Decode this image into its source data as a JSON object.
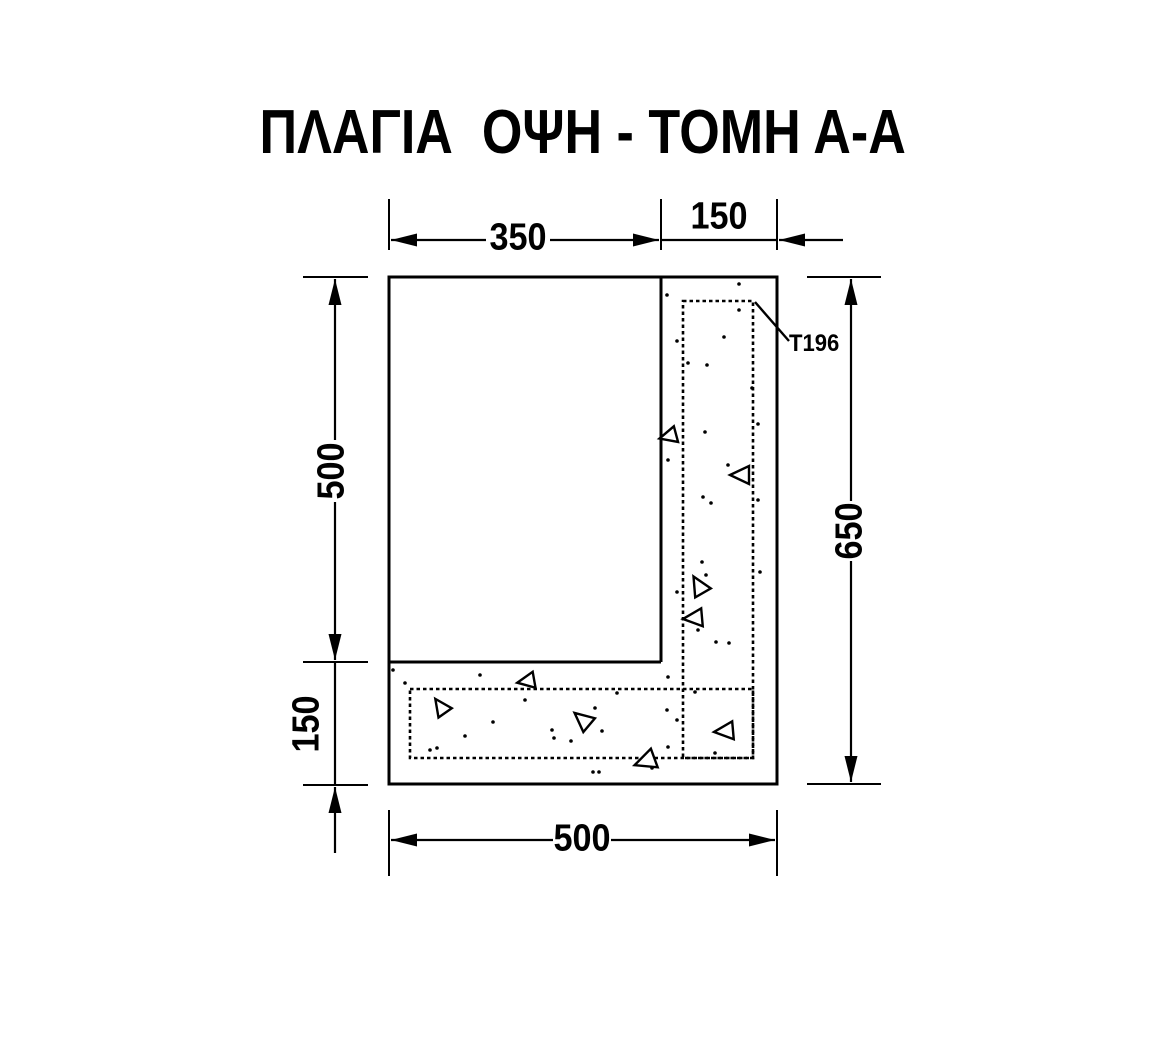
{
  "title": "ΠΛΑΓΙΑ  ΟΨΗ - ΤΟΜΗ Α-Α",
  "labels": {
    "dim_top_main": "350",
    "dim_top_wall": "150",
    "dim_left_upper": "500",
    "dim_left_lower": "150",
    "dim_right_total": "650",
    "dim_bottom_total": "500",
    "mesh_label": "T196"
  },
  "colors": {
    "ink": "#000000",
    "paper": "#ffffff"
  },
  "texture": {
    "dots": [
      [
        739,
        284
      ],
      [
        667,
        295
      ],
      [
        739,
        310
      ],
      [
        677,
        341
      ],
      [
        724,
        337
      ],
      [
        688,
        363
      ],
      [
        707,
        365
      ],
      [
        752,
        388
      ],
      [
        758,
        424
      ],
      [
        705,
        432
      ],
      [
        668,
        460
      ],
      [
        728,
        465
      ],
      [
        758,
        500
      ],
      [
        703,
        497
      ],
      [
        711,
        503
      ],
      [
        702,
        562
      ],
      [
        706,
        575
      ],
      [
        760,
        572
      ],
      [
        677,
        592
      ],
      [
        698,
        630
      ],
      [
        716,
        642
      ],
      [
        729,
        643
      ],
      [
        668,
        677
      ],
      [
        695,
        692
      ],
      [
        667,
        710
      ],
      [
        677,
        720
      ],
      [
        668,
        747
      ],
      [
        715,
        753
      ],
      [
        393,
        670
      ],
      [
        405,
        683
      ],
      [
        480,
        675
      ],
      [
        525,
        700
      ],
      [
        595,
        708
      ],
      [
        617,
        693
      ],
      [
        552,
        730
      ],
      [
        554,
        738
      ],
      [
        571,
        741
      ],
      [
        602,
        731
      ],
      [
        493,
        722
      ],
      [
        465,
        736
      ],
      [
        430,
        750
      ],
      [
        437,
        748
      ],
      [
        593,
        772
      ],
      [
        599,
        772
      ],
      [
        652,
        768
      ]
    ],
    "triangles": [
      {
        "x": 669,
        "y": 436,
        "rot": -15,
        "s": 9
      },
      {
        "x": 741,
        "y": 475,
        "rot": 0,
        "s": 10
      },
      {
        "x": 699,
        "y": 586,
        "rot": 60,
        "s": 10
      },
      {
        "x": 694,
        "y": 618,
        "rot": -5,
        "s": 10
      },
      {
        "x": 527,
        "y": 681,
        "rot": -10,
        "s": 9
      },
      {
        "x": 441,
        "y": 707,
        "rot": 55,
        "s": 9
      },
      {
        "x": 583,
        "y": 720,
        "rot": 40,
        "s": 10
      },
      {
        "x": 725,
        "y": 731,
        "rot": -5,
        "s": 10
      },
      {
        "x": 646,
        "y": 761,
        "rot": -20,
        "s": 11
      }
    ]
  }
}
